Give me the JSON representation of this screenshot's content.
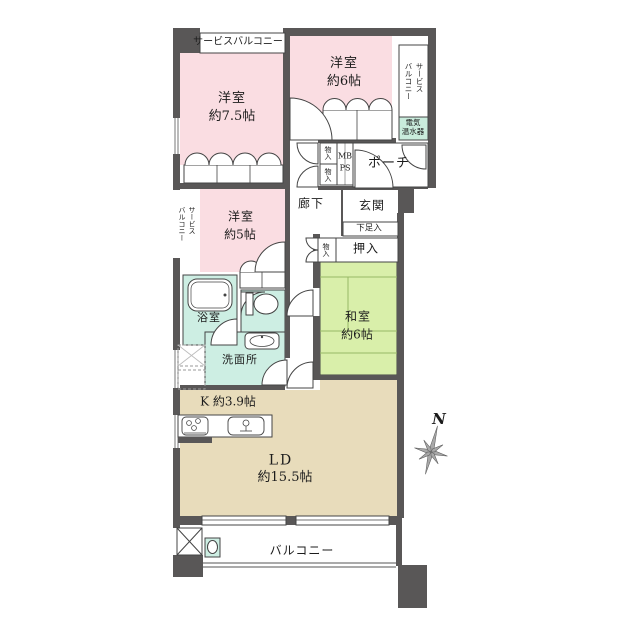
{
  "colors": {
    "wall": "#595757",
    "room_pink": "#fadde2",
    "tatami_green": "#d9efaa",
    "wet_teal": "#cdeee3",
    "ld_beige": "#e8dcbb",
    "heater_teal": "#c9ecdc",
    "line": "#3a3a3a"
  },
  "labels": {
    "service_balcony_top": "サービスバルコニー",
    "service_balcony_col1": "サービス",
    "service_balcony_col2": "バルコニー",
    "water_heater_line1": "電気",
    "water_heater_line2": "温水器",
    "porch": "ポーチ",
    "closet_small": "物入",
    "mb": "MB",
    "ps": "PS",
    "hallway": "廊下",
    "entrance": "玄関",
    "shoe_closet": "下足入",
    "oshiire": "押入",
    "japanese_room_name": "和室",
    "japanese_room_size": "約6帖",
    "western_room_75_name": "洋室",
    "western_room_75_size": "約7.5帖",
    "western_room_6_name": "洋室",
    "western_room_6_size": "約6帖",
    "western_room_5_name": "洋室",
    "western_room_5_size": "約5帖",
    "bathroom": "浴室",
    "washroom": "洗面所",
    "kitchen": "K 約3.9帖",
    "living_dining_name": "LD",
    "living_dining_size": "約15.5帖",
    "balcony": "バルコニー",
    "north": "N"
  }
}
